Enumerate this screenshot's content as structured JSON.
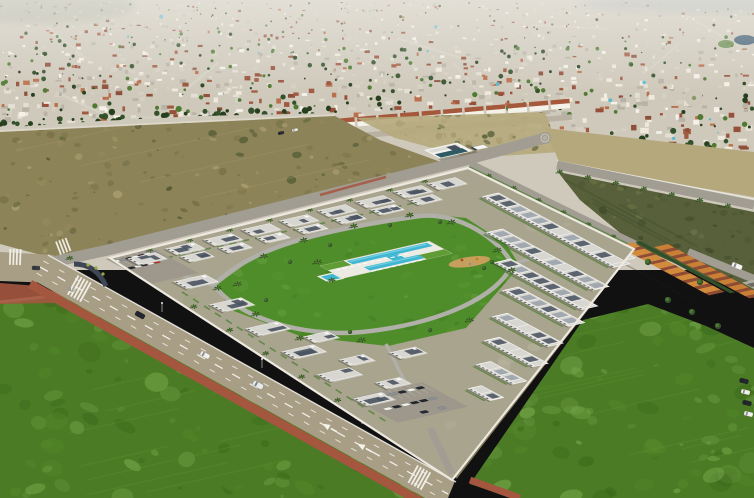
{
  "scene": {
    "type": "aerial-photograph",
    "subject": "Oblique aerial view of a new white residential development with a communal pool, bordered by roads, green fields, vacant scrubland and a dense Mediterranean town behind"
  },
  "palette": {
    "haze": "#f2f1ec",
    "city_base": "#cfc9bb",
    "city_house": "#f4f1e9",
    "city_house2": "#e4dfd3",
    "city_house3": "#d6d0c2",
    "city_roof": "#a05a41",
    "city_roof2": "#8c4f3a",
    "city_roof3": "#b96f4d",
    "city_road": "#d9d4c8",
    "tree_dark": "#33512a",
    "tree_mid": "#4e7a33",
    "tree_light": "#6f9a44",
    "lagoon": "#2b4d68",
    "dirt": "#8d8359",
    "dirt_dark": "#6b6a42",
    "dirt_light": "#a99c70",
    "scrub_bush": "#4f5a33",
    "sand": "#b5a87c",
    "scrub": "#57603b",
    "field": "#4b7c25",
    "field_light": "#6e9c44",
    "field_dark": "#3a6519",
    "road": "#a89d85",
    "road_minor": "#a19d92",
    "marking": "#f4f3ec",
    "sidewalk_red": "#a4563f",
    "curb": "#e9e7df",
    "plot": "#a8a48e",
    "lawn": "#4f8d2a",
    "lawn_light": "#6fa846",
    "path": "#b0afa8",
    "deck": "#ecebe3",
    "pool": "#3fb6d2",
    "pool_light": "#85d8e6",
    "wall": "#eee9e0",
    "bld_wall": "#f6f5f1",
    "bld_face": "#e7e5dd",
    "bld_roof": "#d7d6d1",
    "panel": "#4a5360",
    "window": "#55606b",
    "hedge": "#54803a",
    "sand_play": "#c79e5c",
    "orange": "#d28a3c",
    "orange2": "#c97f35",
    "orange_roof": "#8f4b33",
    "grey_bld": "#b2ada2",
    "teal_glass": "#2e5a63",
    "car_dark": "#23272e",
    "car_white": "#f2f1ec",
    "car_grey": "#8d9298",
    "car_red": "#b02a20",
    "pool_dot": "#4fb8cf",
    "pole": "#8a8a86",
    "dark_pave": "#3d4654",
    "bush_yellow": "#9aa83f"
  },
  "regions": [
    {
      "name": "town-background",
      "label": "dense town, white houses with terracotta roofs"
    },
    {
      "name": "vacant-lot-left",
      "label": "empty scrubland plot"
    },
    {
      "name": "vacant-lot-right",
      "label": "scrub rows with palm-lined road"
    },
    {
      "name": "residential-development",
      "label": "walled complex of white flat-roof apartment blocks"
    },
    {
      "name": "courtyard",
      "label": "landscaped lawn with paths"
    },
    {
      "name": "swimming-pool",
      "label": "turquoise communal pool with sun loungers"
    },
    {
      "name": "playground",
      "label": "sandy play area"
    },
    {
      "name": "main-road",
      "label": "diagonal avenue with red sidewalk"
    },
    {
      "name": "green-field-left",
      "label": "bright green meadow"
    },
    {
      "name": "green-field-right",
      "label": "bright green meadow"
    },
    {
      "name": "orange-townhouses",
      "label": "existing terracotta townhouses"
    }
  ],
  "objects": {
    "cars_total": 37,
    "cars_on_main_road": 3,
    "parked_cars_west_lot": 12,
    "parked_cars_south_lot": 15,
    "parked_cars_east_edge": 4,
    "apartment_blocks": 34,
    "palm_trees": 42,
    "sun_loungers": 19,
    "crosswalks": 4,
    "swimming_pools": 3,
    "roundabouts": 2,
    "parking_lots": 3,
    "playgrounds": 1
  }
}
